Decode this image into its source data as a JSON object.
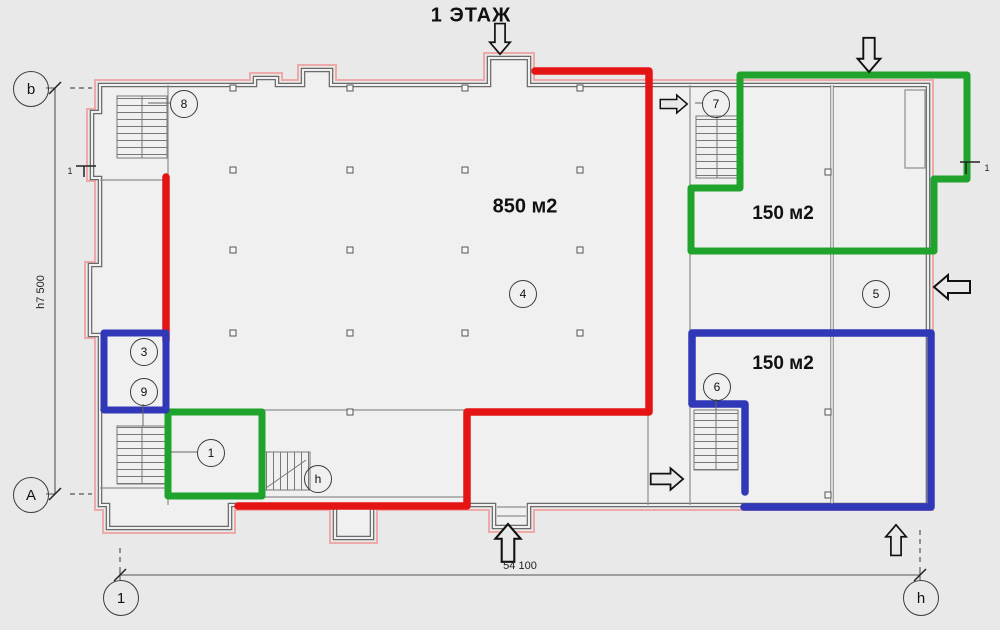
{
  "title": {
    "text": "1 ЭТАЖ"
  },
  "zones": {
    "hall": {
      "label": "850 м2",
      "outline": "red"
    },
    "top_right": {
      "label": "150 м2",
      "outline": "green"
    },
    "bottom_right": {
      "label": "150 м2",
      "outline": "blue"
    }
  },
  "dimensions": {
    "total_width": "54 100",
    "total_height": "h7 500"
  },
  "bubbles": {
    "b": "b",
    "a": "А",
    "one": "1",
    "h": "h",
    "r8": "8",
    "r7": "7",
    "r3": "3",
    "r9": "9",
    "r4": "4",
    "r5": "5",
    "r6": "6",
    "r1": "1",
    "rh": "h"
  },
  "section_marks": {
    "left": "1",
    "right": "1"
  },
  "colors": {
    "wall": "#6a6a6a",
    "wall_fill": "#f0f0f0",
    "offset_pink": "#eea9a9",
    "red": "#e41414",
    "green": "#1fa32c",
    "blue": "#3038b8",
    "background": "#e9e9e9"
  }
}
